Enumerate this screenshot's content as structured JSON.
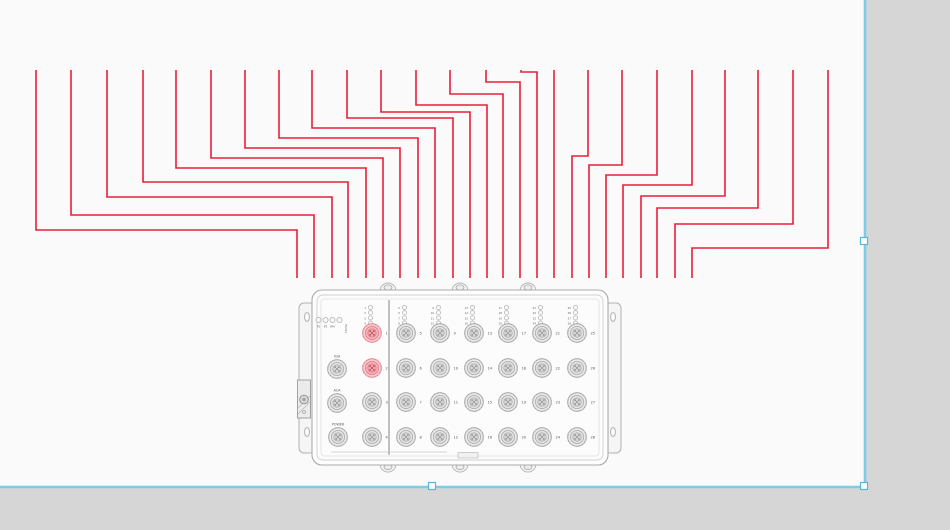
{
  "canvas": {
    "page": {
      "width": 864,
      "height": 486,
      "bg": "#fafafa",
      "pasteboard_bg": "#d6d6d6"
    },
    "selection": {
      "border_color": "#7ecbe8",
      "handle_fill": "#ffffff",
      "handle_stroke": "#54b7dd",
      "handles": [
        {
          "name": "selection-handle-mid-right",
          "x": 864,
          "y": 241
        },
        {
          "name": "selection-handle-bottom-right",
          "x": 864,
          "y": 486
        },
        {
          "name": "selection-handle-bottom-mid",
          "x": 432,
          "y": 486
        }
      ]
    }
  },
  "wires": {
    "color": "#e81e3a",
    "width": 1.6,
    "top_y": 70,
    "end_y": 278,
    "routes": [
      {
        "top_x": 36,
        "jog_y": 230,
        "end_x": 297
      },
      {
        "top_x": 71,
        "jog_y": 215,
        "end_x": 314
      },
      {
        "top_x": 107,
        "jog_y": 197,
        "end_x": 332
      },
      {
        "top_x": 143,
        "jog_y": 182,
        "end_x": 348
      },
      {
        "top_x": 176,
        "jog_y": 168,
        "end_x": 366
      },
      {
        "top_x": 211,
        "jog_y": 158,
        "end_x": 383
      },
      {
        "top_x": 245,
        "jog_y": 148,
        "end_x": 400
      },
      {
        "top_x": 279,
        "jog_y": 138,
        "end_x": 418
      },
      {
        "top_x": 312,
        "jog_y": 128,
        "end_x": 435
      },
      {
        "top_x": 347,
        "jog_y": 118,
        "end_x": 453
      },
      {
        "top_x": 381,
        "jog_y": 112,
        "end_x": 470
      },
      {
        "top_x": 416,
        "jog_y": 105,
        "end_x": 487
      },
      {
        "top_x": 450,
        "jog_y": 94,
        "end_x": 503
      },
      {
        "top_x": 486,
        "jog_y": 82,
        "end_x": 520
      },
      {
        "top_x": 521,
        "jog_y": 72,
        "end_x": 537
      },
      {
        "top_x": 554,
        "jog_y": null,
        "end_x": 554
      },
      {
        "top_x": 588,
        "jog_y": 156,
        "end_x": 572
      },
      {
        "top_x": 622,
        "jog_y": 165,
        "end_x": 589
      },
      {
        "top_x": 657,
        "jog_y": 175,
        "end_x": 606
      },
      {
        "top_x": 692,
        "jog_y": 185,
        "end_x": 623
      },
      {
        "top_x": 725,
        "jog_y": 196,
        "end_x": 641
      },
      {
        "top_x": 758,
        "jog_y": 208,
        "end_x": 657
      },
      {
        "top_x": 793,
        "jog_y": 224,
        "end_x": 675
      },
      {
        "top_x": 828,
        "jog_y": 248,
        "end_x": 692
      }
    ]
  },
  "device": {
    "frame_stroke": "#aeaeae",
    "face_fill": "#fcfcfc",
    "status_leds": {
      "labels": [
        "P1",
        "P2",
        "RM",
        "FAULT"
      ]
    },
    "special_ports": [
      {
        "label": "X2A",
        "x": 337,
        "y": 369
      },
      {
        "label": "ACA",
        "x": 337,
        "y": 403
      },
      {
        "label": "POWER",
        "x": 338,
        "y": 437
      }
    ],
    "row_ys": [
      333,
      368,
      402,
      437
    ],
    "led_stack_top_y": 307.5,
    "columns": [
      {
        "x": 372,
        "ports": [
          "1",
          "2",
          "3",
          "4"
        ],
        "highlighted": [
          "1",
          "2"
        ]
      },
      {
        "x": 406,
        "ports": [
          "5",
          "6",
          "7",
          "8"
        ]
      },
      {
        "x": 440,
        "ports": [
          "9",
          "10",
          "11",
          "12"
        ]
      },
      {
        "x": 474,
        "ports": [
          "13",
          "14",
          "15",
          "16"
        ]
      },
      {
        "x": 508,
        "ports": [
          "17",
          "18",
          "19",
          "20"
        ]
      },
      {
        "x": 542,
        "ports": [
          "21",
          "22",
          "23",
          "24"
        ]
      },
      {
        "x": 577,
        "ports": [
          "25",
          "26",
          "27",
          "28"
        ]
      }
    ],
    "normal_port": {
      "fill": "#ebebeb",
      "stroke": "#9d9d9d",
      "pin": "#8e8e8e"
    },
    "highlight_port": {
      "fill": "#f8c9ce",
      "stroke": "#e37983",
      "pin": "#bd4250"
    }
  }
}
